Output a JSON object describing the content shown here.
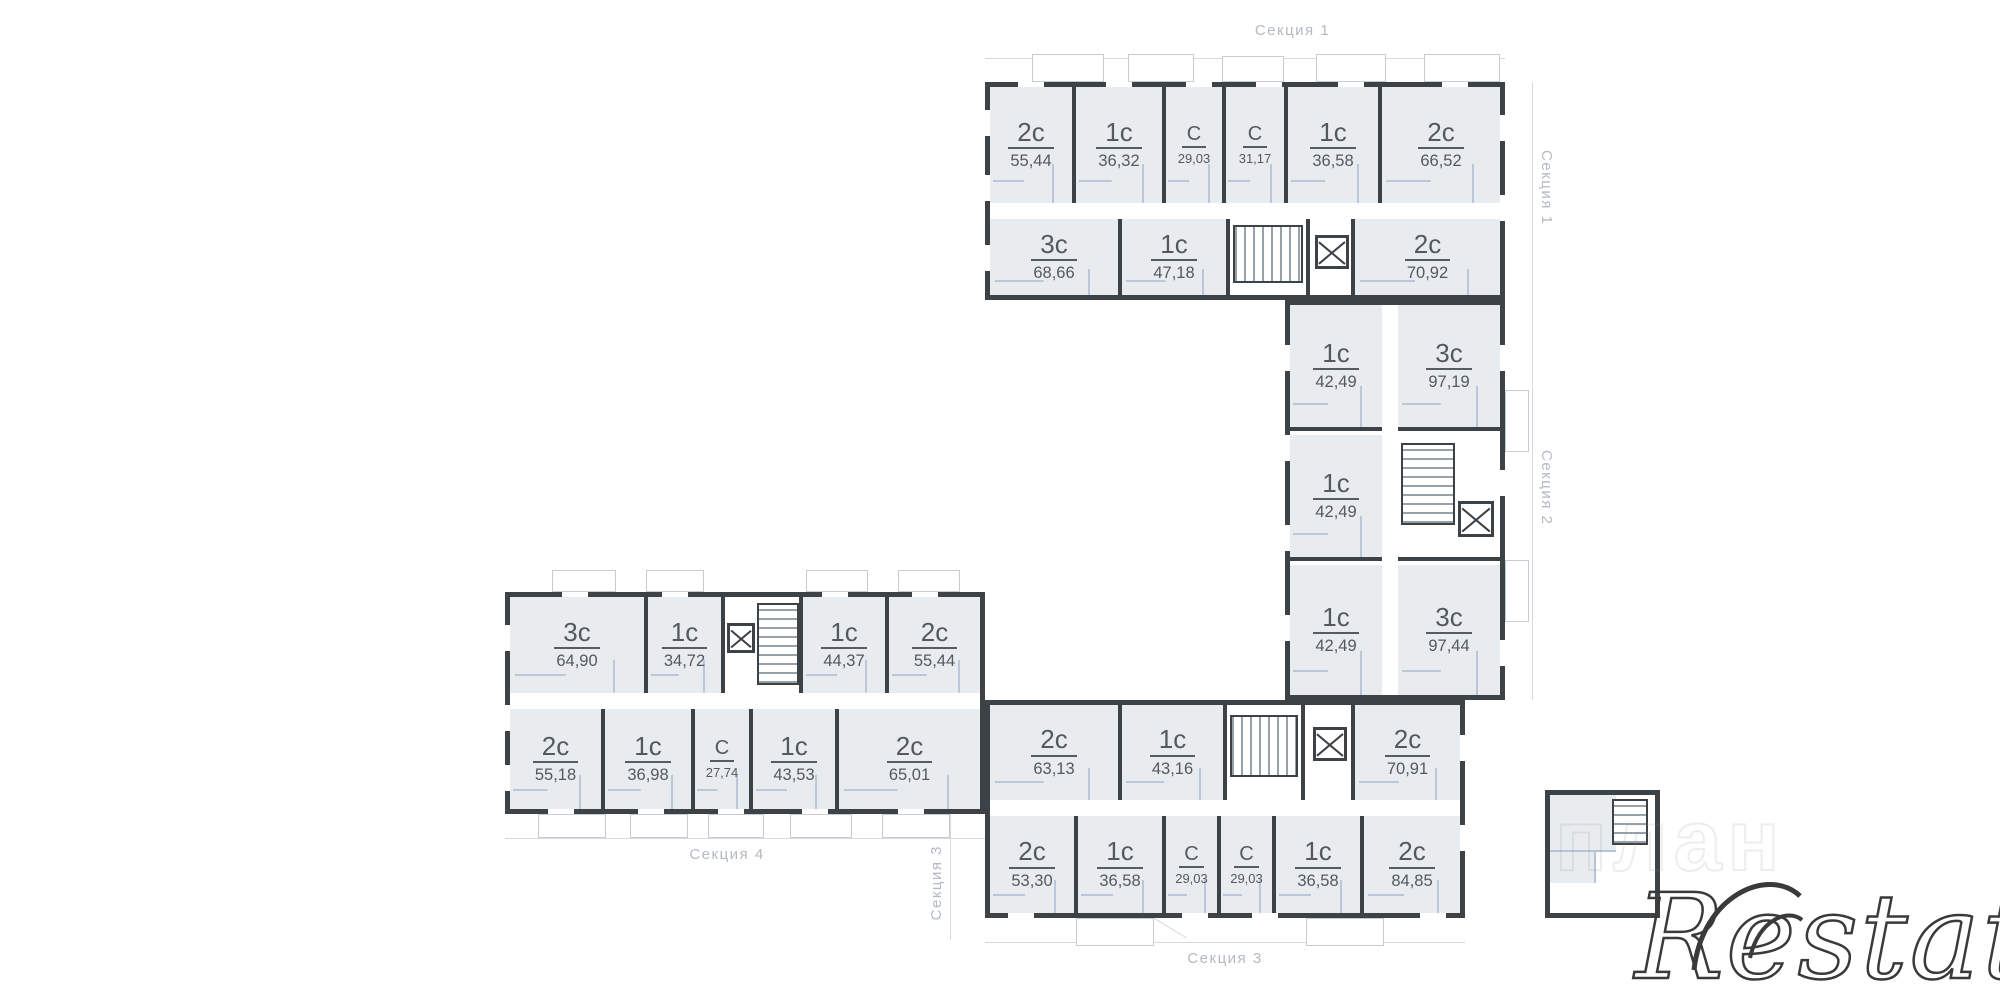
{
  "sections": {
    "s1": {
      "label_top": "Секция 1",
      "label_side": "Секция 1",
      "top": [
        {
          "type": "2с",
          "area": "55,44"
        },
        {
          "type": "1с",
          "area": "36,32"
        },
        {
          "type": "С",
          "area": "29,03"
        },
        {
          "type": "С",
          "area": "31,17"
        },
        {
          "type": "1с",
          "area": "36,58"
        },
        {
          "type": "2с",
          "area": "66,52"
        }
      ],
      "bottom": [
        {
          "type": "3с",
          "area": "68,66"
        },
        {
          "type": "1с",
          "area": "47,18"
        },
        {
          "type": "2с",
          "area": "70,92"
        }
      ]
    },
    "s2": {
      "label_side": "Секция 2",
      "left": [
        {
          "type": "1с",
          "area": "42,49"
        },
        {
          "type": "1с",
          "area": "42,49"
        },
        {
          "type": "1с",
          "area": "42,49"
        }
      ],
      "right": [
        {
          "type": "3с",
          "area": "97,19"
        },
        {
          "type": "3с",
          "area": "97,44"
        }
      ]
    },
    "s3": {
      "label_bottom": "Секция 3",
      "label_side": "Секция 3",
      "top": [
        {
          "type": "2с",
          "area": "63,13"
        },
        {
          "type": "1с",
          "area": "43,16"
        },
        {
          "type": "2с",
          "area": "70,91"
        }
      ],
      "bottom": [
        {
          "type": "2с",
          "area": "53,30"
        },
        {
          "type": "1с",
          "area": "36,58"
        },
        {
          "type": "С",
          "area": "29,03"
        },
        {
          "type": "С",
          "area": "29,03"
        },
        {
          "type": "1с",
          "area": "36,58"
        },
        {
          "type": "2с",
          "area": "84,85"
        }
      ]
    },
    "s4": {
      "label_bottom": "Секция 4",
      "top": [
        {
          "type": "3с",
          "area": "64,90"
        },
        {
          "type": "1с",
          "area": "34,72"
        },
        {
          "type": "1с",
          "area": "44,37"
        },
        {
          "type": "2с",
          "area": "55,44"
        }
      ],
      "bottom": [
        {
          "type": "2с",
          "area": "55,18"
        },
        {
          "type": "1с",
          "area": "36,98"
        },
        {
          "type": "С",
          "area": "27,74"
        },
        {
          "type": "1с",
          "area": "43,53"
        },
        {
          "type": "2с",
          "area": "65,01"
        }
      ]
    }
  },
  "watermark": {
    "brand": "Restate",
    "ghost": "план"
  }
}
